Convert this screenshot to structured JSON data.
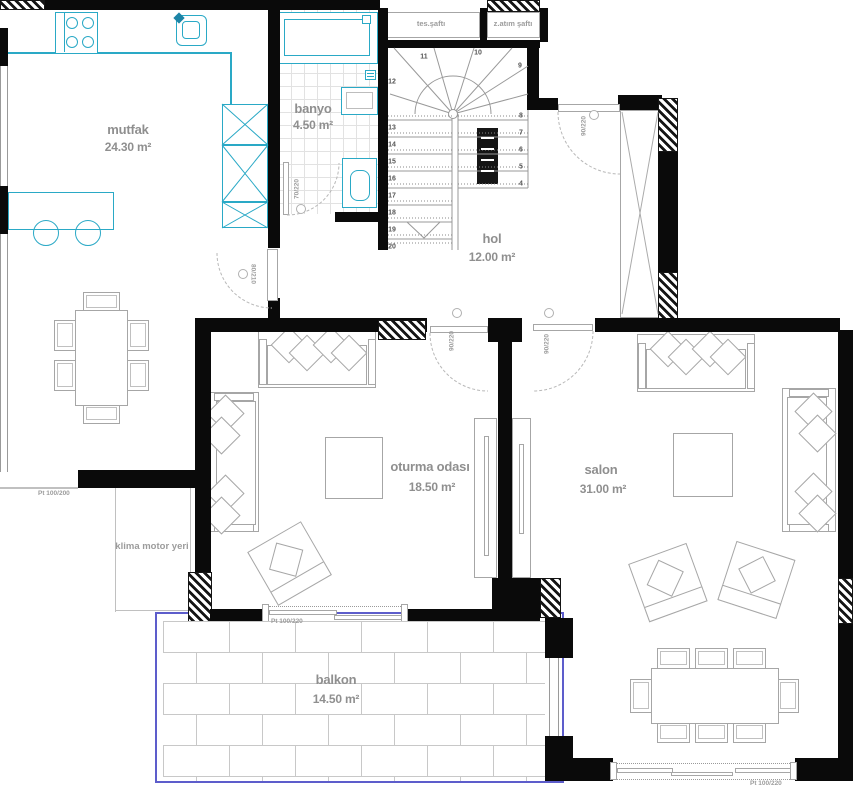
{
  "rooms": {
    "mutfak": {
      "name": "mutfak",
      "area": "24.30 m²"
    },
    "banyo": {
      "name": "banyo",
      "area": "4.50 m²"
    },
    "hol": {
      "name": "hol",
      "area": "12.00 m²"
    },
    "oturma": {
      "name": "oturma odası",
      "area": "18.50 m²"
    },
    "salon": {
      "name": "salon",
      "area": "31.00 m²"
    },
    "balkon": {
      "name": "balkon",
      "area": "14.50 m²"
    }
  },
  "shafts": {
    "left": "tes.şaftı",
    "right": "z.atım şaftı"
  },
  "annotations": {
    "klima": "klima motor yeri",
    "window_left": "Pt 100/200",
    "balcony_door": "Pt 100/220",
    "salon_door_bottom": "Pt 100/220"
  },
  "doors": {
    "banyo": "70/220",
    "mutfak": "80/210",
    "oturma": "90/220",
    "salon": "90/220",
    "entry": "90/220"
  },
  "stairs": {
    "top": [
      "11",
      "10",
      "9"
    ],
    "left": [
      "12",
      "13",
      "14",
      "15",
      "16",
      "17",
      "18",
      "19",
      "20"
    ],
    "right": [
      "8",
      "7",
      "6",
      "5",
      "4"
    ]
  },
  "colors": {
    "wall": "#0a0a0a",
    "fixture": "#2aa9c6",
    "furniture": "#a6a6a6",
    "label": "#8f8f8f",
    "balcony_border": "#5d5dcb"
  }
}
